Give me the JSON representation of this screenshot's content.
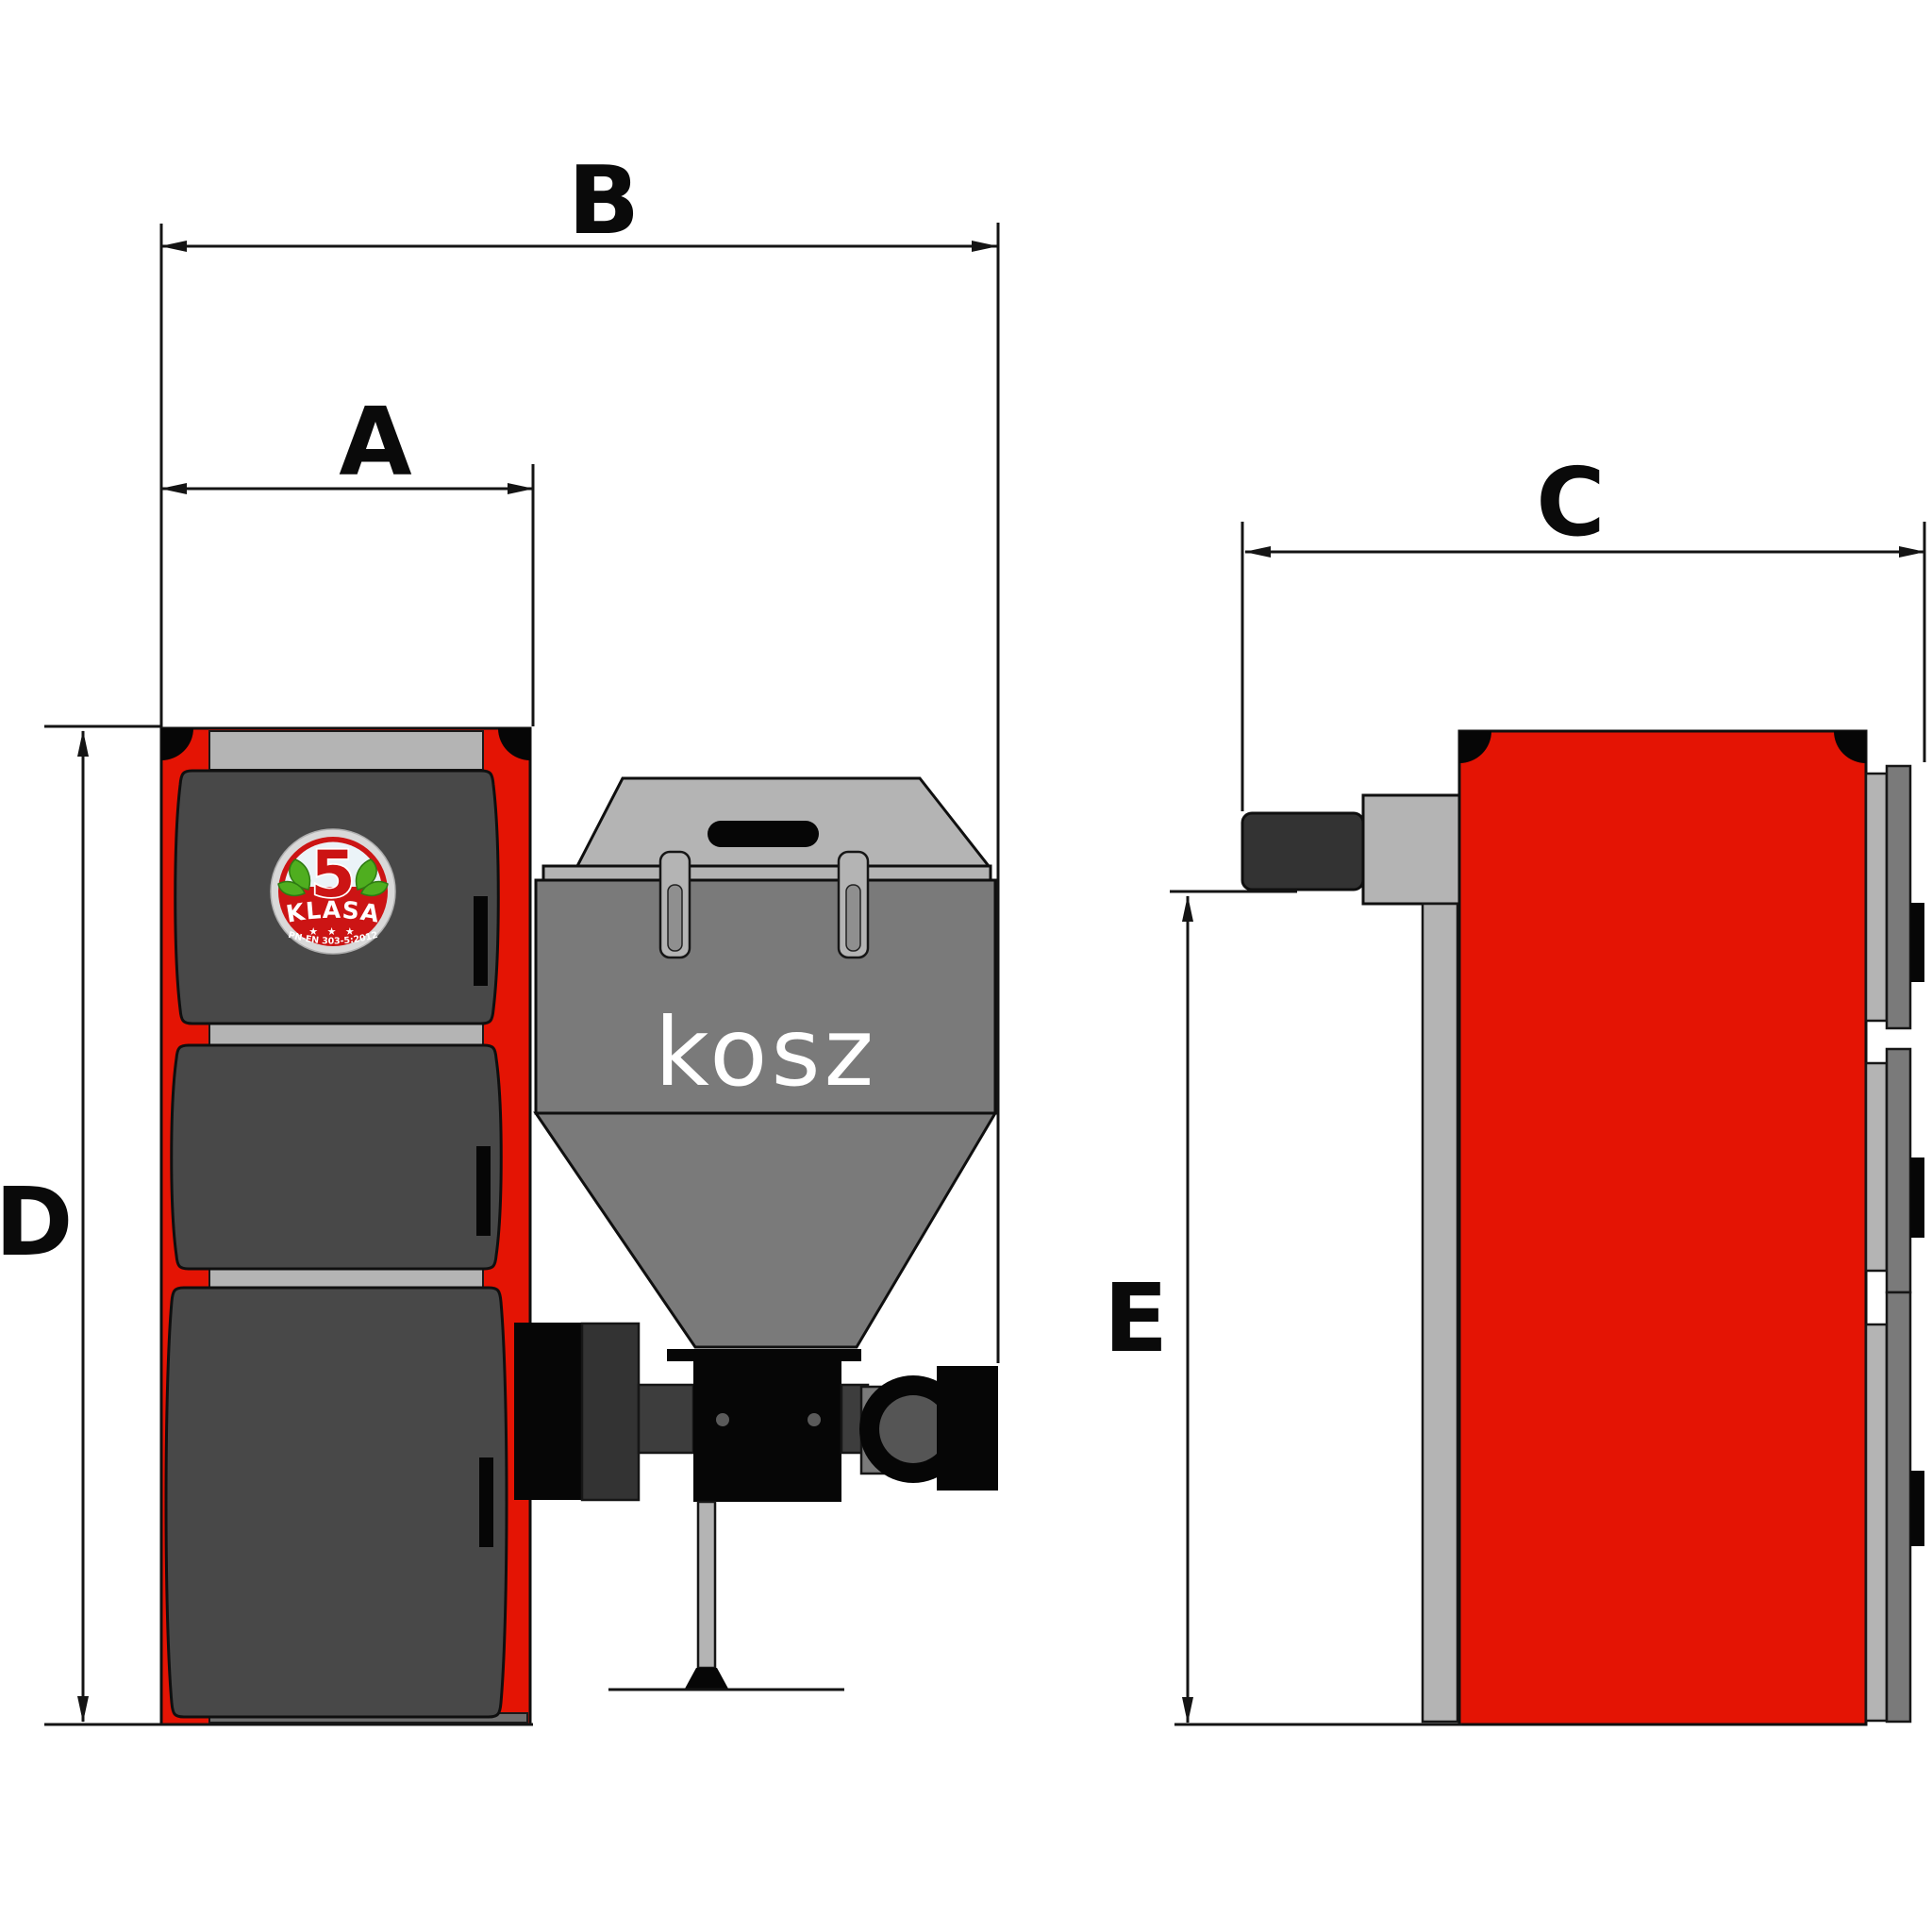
{
  "dimensions": {
    "a": "A",
    "b": "B",
    "c": "C",
    "d": "D",
    "e": "E"
  },
  "hopper": {
    "label": "kosz"
  },
  "badge": {
    "number": "5",
    "name": "KLASA",
    "stars": "★ ★ ★",
    "standard": "PN-EN 303-5:2012"
  },
  "colors": {
    "background": "#ffffff",
    "boiler_red": "#e41404",
    "door_gray": "#484848",
    "hopper_gray": "#7a7a7a",
    "light_gray": "#b4b4b4",
    "flue_dark": "#333333",
    "duct_dark": "#3d3d3d",
    "line_black": "#141414",
    "badge_red": "#cc1414",
    "badge_light": "#ebf3f8",
    "leaf_green": "#4fae1f"
  }
}
